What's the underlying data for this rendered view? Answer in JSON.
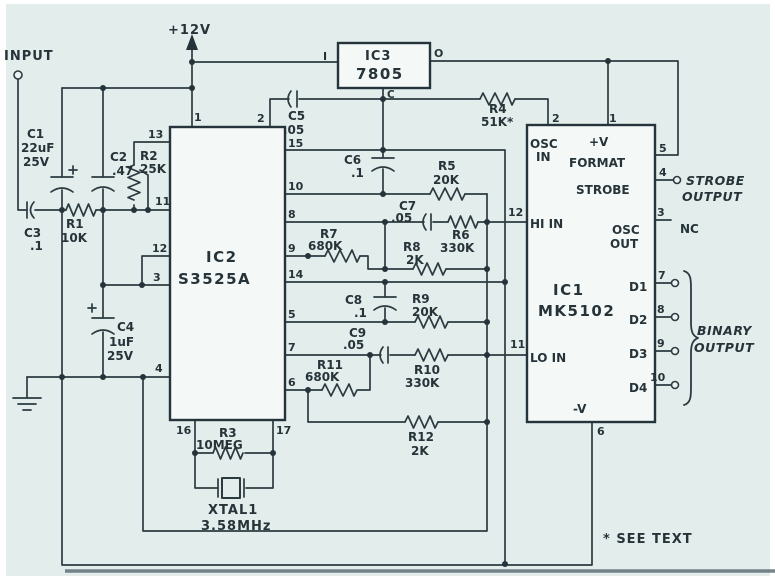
{
  "colors": {
    "ink": "#2c3b41",
    "paper": "#e3edec"
  },
  "labels": {
    "input": "INPUT",
    "power": "+12V",
    "see_text": "* SEE TEXT",
    "strobe_l1": "STROBE",
    "strobe_l2": "OUTPUT",
    "binary_l1": "BINARY",
    "binary_l2": "OUTPUT",
    "nc": "NC"
  },
  "ic3": {
    "ref": "IC3",
    "part": "7805",
    "in": "I",
    "out": "O",
    "com": "C"
  },
  "ic2": {
    "ref": "IC2",
    "part": "S3525A",
    "pins": {
      "1": "1",
      "2": "2",
      "3": "3",
      "4": "4",
      "5": "5",
      "6": "6",
      "7": "7",
      "8": "8",
      "9": "9",
      "10": "10",
      "11": "11",
      "12": "12",
      "13": "13",
      "14": "14",
      "15": "15",
      "16": "16",
      "17": "17"
    }
  },
  "ic1": {
    "ref": "IC1",
    "part": "MK5102",
    "osc_in_l1": "OSC",
    "osc_in_l2": "IN",
    "plus_v": "+V",
    "format": "FORMAT",
    "strobe": "STROBE",
    "hi_in": "HI IN",
    "osc_out_l1": "OSC",
    "osc_out_l2": "OUT",
    "lo_in": "LO IN",
    "d1": "D1",
    "d2": "D2",
    "d3": "D3",
    "d4": "D4",
    "minus_v": "-V",
    "pins": {
      "1": "1",
      "2": "2",
      "3": "3",
      "4": "4",
      "5": "5",
      "6": "6",
      "7": "7",
      "8": "8",
      "9": "9",
      "10": "10",
      "11": "11",
      "12": "12"
    }
  },
  "components": {
    "c1": {
      "ref": "C1",
      "v1": "22uF",
      "v2": "25V"
    },
    "c2": {
      "ref": "C2",
      "v1": ".47"
    },
    "c3": {
      "ref": "C3",
      "v1": ".1"
    },
    "c4": {
      "ref": "C4",
      "v1": "1uF",
      "v2": "25V"
    },
    "c5": {
      "ref": "C5",
      "v1": ".05"
    },
    "c6": {
      "ref": "C6",
      "v1": ".1"
    },
    "c7": {
      "ref": "C7",
      "v1": ".05"
    },
    "c8": {
      "ref": "C8",
      "v1": ".1"
    },
    "c9": {
      "ref": "C9",
      "v1": ".05"
    },
    "r1": {
      "ref": "R1",
      "v1": "10K"
    },
    "r2": {
      "ref": "R2",
      "v1": "25K"
    },
    "r3": {
      "ref": "R3",
      "v1": "10MEG"
    },
    "r4": {
      "ref": "R4",
      "v1": "51K*"
    },
    "r5": {
      "ref": "R5",
      "v1": "20K"
    },
    "r6": {
      "ref": "R6",
      "v1": "330K"
    },
    "r7": {
      "ref": "R7",
      "v1": "680K"
    },
    "r8": {
      "ref": "R8",
      "v1": "2K"
    },
    "r9": {
      "ref": "R9",
      "v1": "20K"
    },
    "r10": {
      "ref": "R10",
      "v1": "330K"
    },
    "r11": {
      "ref": "R11",
      "v1": "680K"
    },
    "r12": {
      "ref": "R12",
      "v1": "2K"
    },
    "xtal": {
      "ref": "XTAL1",
      "v1": "3.58MHz"
    }
  }
}
